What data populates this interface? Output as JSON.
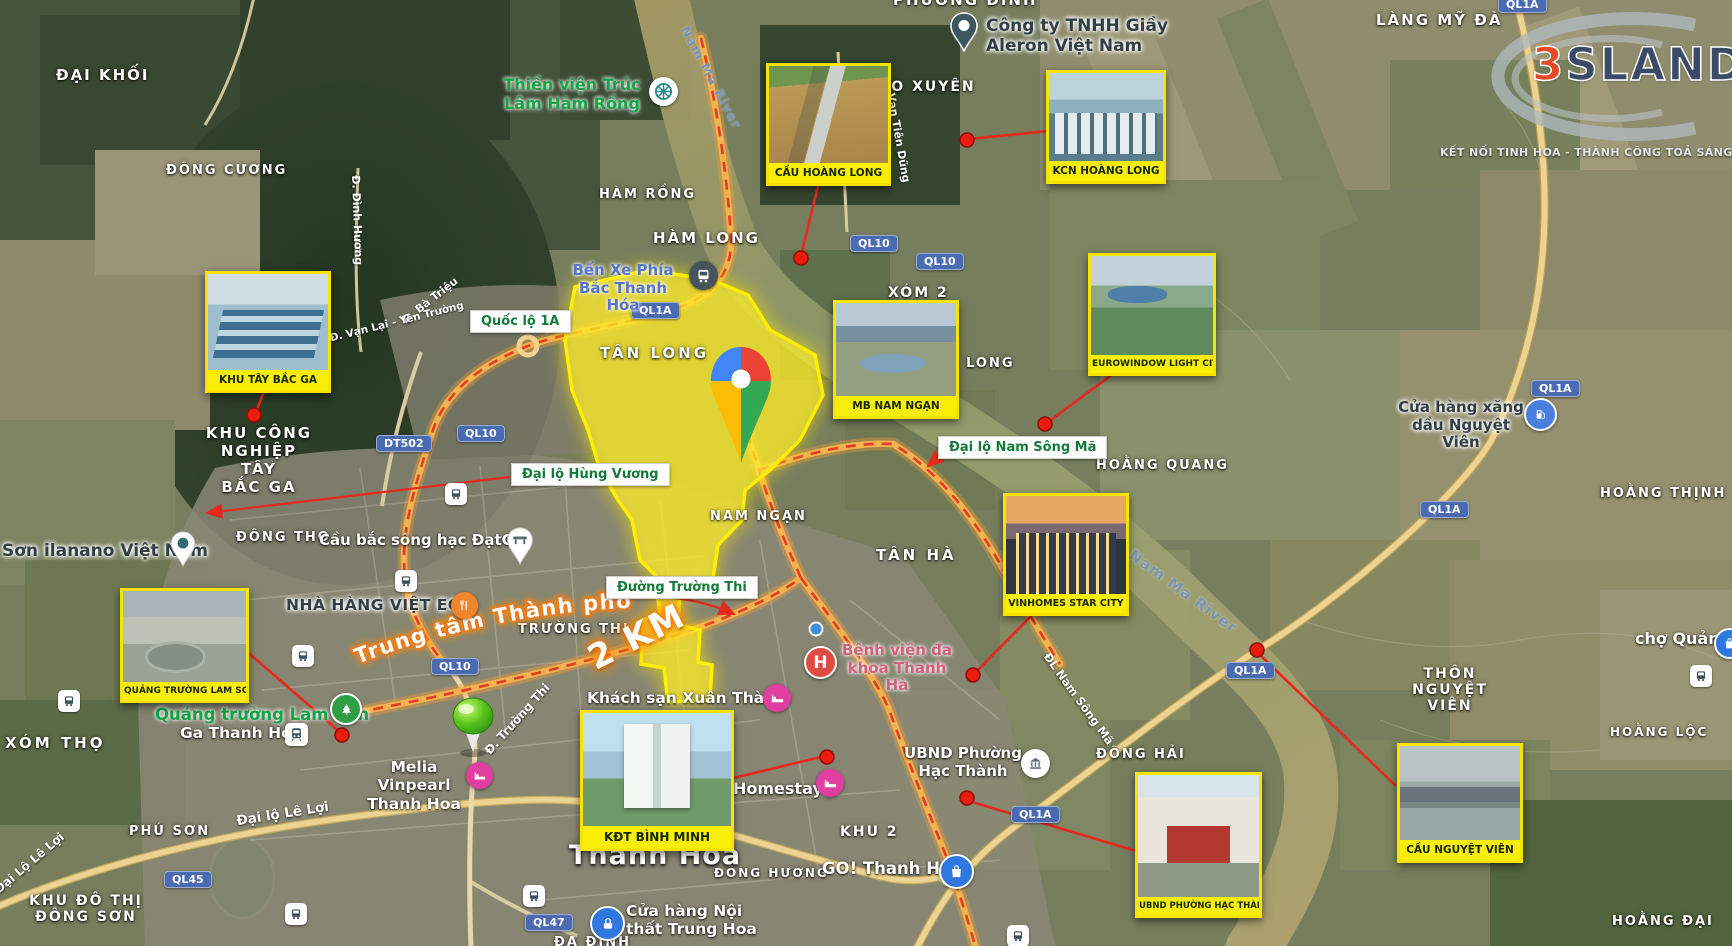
{
  "logo": {
    "three": "3",
    "sland": "SLAND",
    "tagline": "KẾT NỐI TINH HOA - THÀNH CÔNG TOẢ SÁNG"
  },
  "callouts": {
    "cau_hoang_long": "CẦU HOÀNG LONG",
    "kcn_hoang_long": "KCN HOÀNG LONG",
    "eurowindow": "EUROWINDOW LIGHT CITY",
    "mb_nam_ngan": "MB NAM NGẠN",
    "khu_tay_bac_ga": "KHU TÂY BẮC GA",
    "quang_truong_lam_son": "QUẢNG TRƯỜNG LAM SƠN",
    "vinhomes_star_city": "VINHOMES STAR CITY",
    "kdt_binh_minh": "KĐT BÌNH MINH",
    "ubnd_hac_thanh": "UBND PHƯỜNG HẠC THÀNH",
    "cau_nguyet_vien": "CẦU NGUYỆT VIÊN"
  },
  "areas": {
    "dai_khoi": "ĐẠI KHỐI",
    "dong_cuong": "ĐÔNG CƯƠNG",
    "phuong_dinh": "PHƯỜNG ĐÌNH",
    "lang_my_da": "LÀNG MỸ ĐÀ",
    "tao_xuyen": "TÀO XUYÊN",
    "ham_rong": "HÀM RỒNG",
    "ham_long": "HÀM LONG",
    "xom_2": "XÓM 2",
    "tan_long": "TÂN LONG",
    "hoang_long": "HOẰNG LONG",
    "khu_cong_nghiep": "KHU CÔNG\nNGHIỆP TÂY\nBẮC GA",
    "dong_tho": "ĐÔNG THỌ",
    "nam_ngan": "NAM NGẠN",
    "tan_ha": "TÂN HÀ",
    "hoang_quang": "HOẰNG QUANG",
    "hoang_thinh": "HOẰNG THỊNH",
    "truong_thi": "TRƯỜNG THI",
    "xom_tho": "XÓM THỌ",
    "khu_2": "KHU 2",
    "dong_hai": "ĐÔNG HẢI",
    "dong_huong": "ĐÔNG HƯƠNG",
    "hoang_loc": "HOẰNG LỘC",
    "hoang_dai": "HOẰNG ĐẠI",
    "thon_nguyet_vien": "THÔN NGUYỆT\nVIÊN",
    "phu_son": "PHÚ SƠN",
    "khu_do_thi_dong_son": "KHU ĐÔ THỊ\nĐÔNG SƠN",
    "thanh_hoa": "Thanh Hóa",
    "da_dinh": "ĐA ĐINH"
  },
  "pois": {
    "aleron": "Công ty TNHH Giầy\nAleron Việt Nam",
    "thien_vien": "Thiền viện Trúc\nLâm Hàm Rồng",
    "ben_xe": "Bến Xe Phía\nBắc Thanh Hóa",
    "son_ilanano": "Sơn ilanano Việt Nam",
    "viet_eco": "NHÀ HÀNG VIỆT ECO",
    "cau_bac_song_hac": "Cầu bắc sông hạc ĐạtGP",
    "khach_san_xuan_thanh": "Khách sạn Xuân Thành",
    "benh_vien": "Bệnh viện đa\nkhoa Thanh Hà",
    "ubnd": "UBND Phường\nHạc Thành",
    "homestay": "Homestay",
    "melia": "Melia Vinpearl\nThanh Hoa",
    "quang_truong_lam_son": "Quảng trường Lam Sơn",
    "ga_thanh_hoa": "Ga Thanh Hóa",
    "go_thanh_hoa": "GO! Thanh Hóa",
    "noi_that_trung_hoa": "Cửa hàng Nội\nthất Trung Hoa",
    "cho_quang": "chợ Quảng",
    "xang_dau_nguyet_vien": "Cửa hàng xăng\ndầu Nguyệt Viên"
  },
  "roads": {
    "boxes": {
      "quoc_lo_1a": "Quốc lộ 1A",
      "hung_vuong": "Đại lộ Hùng Vương",
      "truong_thi": "Đường Trường Thi",
      "nam_song_ma": "Đại lộ Nam Sông Mã"
    },
    "badges": {
      "ql10": "QL10",
      "ql1a": "QL1A",
      "dt502": "DT502",
      "ql45": "QL45",
      "ql47": "QL47"
    },
    "names": {
      "ba_trieu": "Đ. Bà Triệu",
      "van_lai": "Đ. Vạn Lại - Yên Trường",
      "dinh_huong": "Đ. Đình Hương",
      "van_tien_dung": "Vạn Tiên Dũng",
      "dl_nam_song_ma": "ĐL Nam Sông Mã",
      "d_truong_thi": "Đ. Trường Thi",
      "le_loi": "Đại lộ Lê Lợi",
      "le_loi_2": "Đại Lộ Lê Lợi",
      "nam_ma_river": "Nam Ma River"
    },
    "annotations": {
      "trung_tam": "Trung tâm Thành phố",
      "two_km": "2 KM"
    }
  },
  "glyphs": {
    "hospital": "H"
  },
  "icons": {
    "google-pin-icon": "multicolor google maps pin",
    "project-pin-icon": "glossy green pin",
    "hotel-icon": "bed in magenta circle",
    "hospital-icon": "white H in red circle",
    "restaurant-icon": "cutlery in orange circle",
    "park-icon": "tree in green circle",
    "bus-icon": "bus in white rounded square",
    "train-icon": "train in white rounded square",
    "bus-station-icon": "bus in dark circle",
    "gas-icon": "fuel pump in blue circle",
    "shop-icon": "shopping bag in blue circle",
    "lock-icon": "padlock in blue circle",
    "gov-icon": "government building in white circle",
    "temple-icon": "dharma wheel in white circle",
    "factory-pin-icon": "dark teal map pin",
    "paint-pin-icon": "white map pin",
    "bridge-pin-icon": "white map pin with building",
    "red-dot": "red location dot",
    "blue-dot": "blue transit dot"
  },
  "colors": {
    "callout_yellow": "#f9ee07",
    "highlight_yellow": "#fae93c",
    "connector_red": "#e6281e",
    "badge_blue": "#4a6ab2",
    "road_green_text": "#157a3a",
    "brand_red": "#e84a28",
    "brand_navy": "#3b4a67"
  }
}
